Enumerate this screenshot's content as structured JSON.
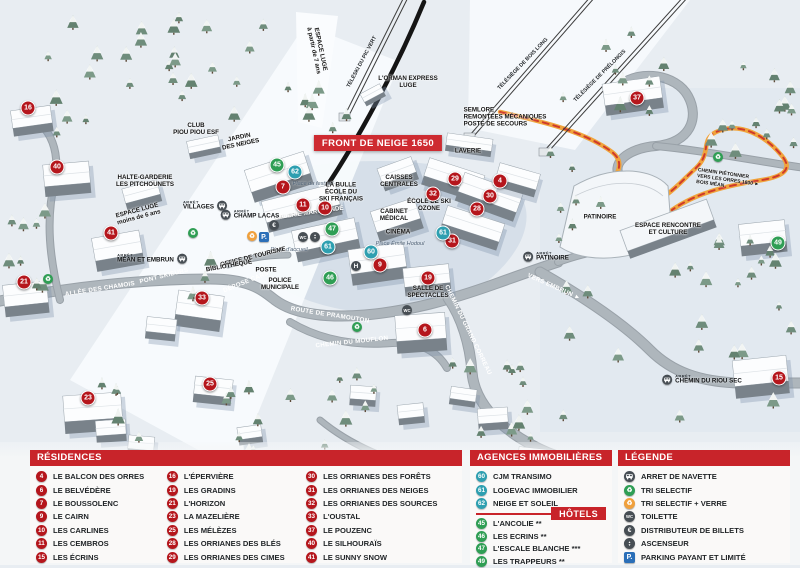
{
  "colors": {
    "residence": "#b5161c",
    "agency": "#2e9fb0",
    "hotel": "#2f9e54",
    "header_red": "#c8242a",
    "path_orange": "#f0a43c",
    "parking_blue": "#2b6fb8"
  },
  "map": {
    "banner": {
      "text": "FRONT DE NEIGE 1650",
      "bg": "#ce2b31"
    },
    "arret_prefix": "ARRÊT",
    "markers": [
      {
        "num": 16,
        "type": "residence",
        "x": 28,
        "y": 108
      },
      {
        "num": 40,
        "type": "residence",
        "x": 57,
        "y": 167
      },
      {
        "num": 41,
        "type": "residence",
        "x": 111,
        "y": 233
      },
      {
        "num": 21,
        "type": "residence",
        "x": 24,
        "y": 282
      },
      {
        "num": 33,
        "type": "residence",
        "x": 202,
        "y": 298
      },
      {
        "num": 23,
        "type": "residence",
        "x": 88,
        "y": 398
      },
      {
        "num": 25,
        "type": "residence",
        "x": 210,
        "y": 384
      },
      {
        "num": 7,
        "type": "residence",
        "x": 283,
        "y": 187
      },
      {
        "num": 11,
        "type": "residence",
        "x": 303,
        "y": 205
      },
      {
        "num": 10,
        "type": "residence",
        "x": 325,
        "y": 208
      },
      {
        "num": 9,
        "type": "residence",
        "x": 380,
        "y": 265
      },
      {
        "num": 19,
        "type": "residence",
        "x": 428,
        "y": 278
      },
      {
        "num": 6,
        "type": "residence",
        "x": 425,
        "y": 330
      },
      {
        "num": 29,
        "type": "residence",
        "x": 455,
        "y": 179
      },
      {
        "num": 4,
        "type": "residence",
        "x": 500,
        "y": 181
      },
      {
        "num": 32,
        "type": "residence",
        "x": 433,
        "y": 194
      },
      {
        "num": 30,
        "type": "residence",
        "x": 490,
        "y": 196
      },
      {
        "num": 28,
        "type": "residence",
        "x": 477,
        "y": 209
      },
      {
        "num": 31,
        "type": "residence",
        "x": 452,
        "y": 241
      },
      {
        "num": 37,
        "type": "residence",
        "x": 637,
        "y": 98
      },
      {
        "num": 15,
        "type": "residence",
        "x": 779,
        "y": 378
      },
      {
        "num": 62,
        "type": "agency",
        "x": 295,
        "y": 172
      },
      {
        "num": 61,
        "type": "agency",
        "x": 328,
        "y": 247
      },
      {
        "num": 61,
        "type": "agency",
        "x": 443,
        "y": 233
      },
      {
        "num": 60,
        "type": "agency",
        "x": 371,
        "y": 252
      },
      {
        "num": 45,
        "type": "hotel",
        "x": 277,
        "y": 165
      },
      {
        "num": 47,
        "type": "hotel",
        "x": 332,
        "y": 229
      },
      {
        "num": 46,
        "type": "hotel",
        "x": 330,
        "y": 278
      },
      {
        "num": 49,
        "type": "hotel",
        "x": 778,
        "y": 243
      }
    ],
    "poi_labels": [
      {
        "id": "club-piou-piou",
        "lines": [
          "CLUB",
          "PIOU PIOU ESF"
        ],
        "x": 196,
        "y": 129
      },
      {
        "id": "jardin-des-neiges",
        "lines": [
          "JARDIN",
          "DES NEIGES"
        ],
        "x": 240,
        "y": 141,
        "rot": -12
      },
      {
        "id": "halte-garderie",
        "lines": [
          "HALTE-GARDERIE",
          "LES PITCHOUNETS"
        ],
        "x": 145,
        "y": 181
      },
      {
        "id": "espace-luge-moins-6",
        "lines": [
          "ESPACE LUGE",
          "moins de 6 ans"
        ],
        "x": 138,
        "y": 214,
        "rot": -15
      },
      {
        "id": "espace-luge-7",
        "lines": [
          "ESPACE LUGE",
          "à partir de 7 ans"
        ],
        "x": 317,
        "y": 50,
        "rot": 78
      },
      {
        "id": "orman-express",
        "lines": [
          "L'ORMAN EXPRESS",
          "LUGE"
        ],
        "x": 408,
        "y": 82
      },
      {
        "id": "semlore",
        "lines": [
          "SEMLORE",
          "REMONTÉES MÉCANIQUES",
          "POSTE DE SECOURS"
        ],
        "x": 505,
        "y": 117,
        "cls": "left"
      },
      {
        "id": "laverie",
        "lines": [
          "LAVERIE"
        ],
        "x": 468,
        "y": 151
      },
      {
        "id": "caisses-centrales",
        "lines": [
          "CAISSES",
          "CENTRALES"
        ],
        "x": 399,
        "y": 181
      },
      {
        "id": "la-bulle-esf",
        "lines": [
          "LA BULLE",
          "ÉCOLE DU",
          "SKI FRANÇAIS"
        ],
        "x": 341,
        "y": 192
      },
      {
        "id": "ecole-ski-ozone",
        "lines": [
          "ÉCOLE DE SKI",
          "OZONE"
        ],
        "x": 429,
        "y": 205
      },
      {
        "id": "cabinet-medical",
        "lines": [
          "CABINET",
          "MÉDICAL"
        ],
        "x": 394,
        "y": 215
      },
      {
        "id": "cinema",
        "lines": [
          "CINÉMA"
        ],
        "x": 398,
        "y": 232
      },
      {
        "id": "galerie-marchande",
        "lines": [
          "GALERIE MARCHANDE"
        ],
        "x": 309,
        "y": 213,
        "cls": "white",
        "rot": -8
      },
      {
        "id": "office-de-tourisme",
        "lines": [
          "OFFICE DE TOURISME"
        ],
        "x": 253,
        "y": 257,
        "rot": -14
      },
      {
        "id": "bibliotheque",
        "lines": [
          "BIBLIOTHÈQUE"
        ],
        "x": 229,
        "y": 266,
        "rot": -10
      },
      {
        "id": "poste",
        "lines": [
          "POSTE"
        ],
        "x": 266,
        "y": 270
      },
      {
        "id": "police-municipale",
        "lines": [
          "POLICE",
          "MUNICIPALE"
        ],
        "x": 280,
        "y": 284
      },
      {
        "id": "salle-de-spectacles",
        "lines": [
          "SALLE DE",
          "SPECTACLES"
        ],
        "x": 428,
        "y": 292
      },
      {
        "id": "patinoire-batiment",
        "lines": [
          "PATINOIRE"
        ],
        "x": 600,
        "y": 217
      },
      {
        "id": "espace-rencontre",
        "lines": [
          "ESPACE RENCONTRE",
          "ET CULTURE"
        ],
        "x": 668,
        "y": 229
      },
      {
        "id": "chemin-pietonnier",
        "lines": [
          "CHEMIN PIÉTONNIER",
          "VERS LES ORRES 1800 ►",
          "BOIS MÉAN"
        ],
        "x": 728,
        "y": 181,
        "cls": "tiny left",
        "rot": 8
      }
    ],
    "place_labels": [
      {
        "text": "Place du festival",
        "x": 313,
        "y": 184
      },
      {
        "text": "Place d'accueil",
        "x": 289,
        "y": 250
      },
      {
        "text": "Place Émile Hodoul",
        "x": 400,
        "y": 244
      }
    ],
    "road_labels": [
      {
        "text": "ALLÉE DES CHAMOIS",
        "x": 100,
        "y": 289,
        "rot": -9
      },
      {
        "text": "PONT SKIEURS",
        "x": 164,
        "y": 276,
        "rot": -14
      },
      {
        "text": "DÉPOSE CARS",
        "x": 246,
        "y": 282,
        "rot": -22
      },
      {
        "text": "ROUTE DE PRAMOUTON",
        "x": 330,
        "y": 315,
        "rot": 9
      },
      {
        "text": "CHEMIN DU MOUFLON",
        "x": 352,
        "y": 342,
        "rot": -6
      },
      {
        "text": "CHEMIN DU GRAND CORREAU",
        "x": 468,
        "y": 330,
        "rot": 64
      },
      {
        "text": "VERS EMBRUN ►",
        "x": 554,
        "y": 287,
        "rot": 24
      }
    ],
    "lift_labels": [
      {
        "text": "TÉLÉSKI DU PIC VERT",
        "x": 362,
        "y": 62,
        "rot": -62
      },
      {
        "text": "TÉLÉSIÈGE DE BOIS LONG",
        "x": 523,
        "y": 64,
        "rot": -46
      },
      {
        "text": "TÉLÉSIÈGE DE PRÉLONGIS",
        "x": 600,
        "y": 76,
        "rot": -45
      }
    ],
    "bus_stops": [
      {
        "name": "VILLAGES",
        "x": 205,
        "y": 206,
        "icon_side": "right"
      },
      {
        "name": "MÉAN ET EMBRUN",
        "x": 152,
        "y": 259,
        "icon_side": "right"
      },
      {
        "name": "CHAMP LACAS",
        "x": 250,
        "y": 215,
        "icon_side": "left"
      },
      {
        "name": "PATINOIRE",
        "x": 546,
        "y": 257,
        "icon_side": "left"
      },
      {
        "name": "CHEMIN DU RIOU SEC",
        "x": 702,
        "y": 380,
        "icon_side": "left"
      }
    ],
    "facility_icons": [
      {
        "type": "recycle-green",
        "x": 48,
        "y": 279
      },
      {
        "type": "recycle-green",
        "x": 193,
        "y": 233
      },
      {
        "type": "recycle-green",
        "x": 357,
        "y": 327
      },
      {
        "type": "recycle-green",
        "x": 718,
        "y": 157
      },
      {
        "type": "recycle-orange",
        "x": 252,
        "y": 236
      },
      {
        "type": "parking",
        "x": 264,
        "y": 237
      },
      {
        "type": "euro",
        "x": 274,
        "y": 225
      },
      {
        "type": "wc",
        "x": 303,
        "y": 237
      },
      {
        "type": "elevator",
        "x": 315,
        "y": 237
      },
      {
        "type": "h",
        "x": 356,
        "y": 266
      },
      {
        "type": "wc",
        "x": 407,
        "y": 310
      }
    ]
  },
  "legend": {
    "residences": {
      "title": "RÉSIDENCES",
      "items": [
        {
          "num": 4,
          "label": "LE BALCON DES ORRES"
        },
        {
          "num": 6,
          "label": "LE BELVÉDÈRE"
        },
        {
          "num": 7,
          "label": "LE BOUSSOLENC"
        },
        {
          "num": 9,
          "label": "LE CAIRN"
        },
        {
          "num": 10,
          "label": "LES CARLINES"
        },
        {
          "num": 11,
          "label": "LES CEMBROS"
        },
        {
          "num": 15,
          "label": "LES ÉCRINS"
        },
        {
          "num": 16,
          "label": "L'ÉPERVIÈRE"
        },
        {
          "num": 19,
          "label": "LES GRADINS"
        },
        {
          "num": 21,
          "label": "L'HORIZON"
        },
        {
          "num": 23,
          "label": "LA MAZELIÈRE"
        },
        {
          "num": 25,
          "label": "LES MÉLÈZES"
        },
        {
          "num": 28,
          "label": "LES ORRIANES DES BLÉS"
        },
        {
          "num": 29,
          "label": "LES ORRIANES DES CIMES"
        },
        {
          "num": 30,
          "label": "LES ORRIANES DES FORÊTS"
        },
        {
          "num": 31,
          "label": "LES ORRIANES DES NEIGES"
        },
        {
          "num": 32,
          "label": "LES ORRIANES DES SOURCES"
        },
        {
          "num": 33,
          "label": "L'OUSTAL"
        },
        {
          "num": 37,
          "label": "LE POUZENC"
        },
        {
          "num": 40,
          "label": "LE SILHOURAÏS"
        },
        {
          "num": 41,
          "label": "LE SUNNY SNOW"
        }
      ]
    },
    "agencies": {
      "title": "AGENCES IMMOBILIÈRES",
      "items": [
        {
          "num": 60,
          "label": "CJM TRANSIMO"
        },
        {
          "num": 61,
          "label": "LOGEVAC IMMOBILIER"
        },
        {
          "num": 62,
          "label": "NEIGE ET SOLEIL"
        }
      ]
    },
    "hotels": {
      "title": "HÔTELS",
      "items": [
        {
          "num": 45,
          "label": "L'ANCOLIE **"
        },
        {
          "num": 46,
          "label": "LES ECRINS **"
        },
        {
          "num": 47,
          "label": "L'ESCALE BLANCHE ***"
        },
        {
          "num": 49,
          "label": "LES TRAPPEURS **"
        }
      ]
    },
    "legende": {
      "title": "LÉGENDE",
      "items": [
        {
          "icon": "bus",
          "label": "ARRET DE NAVETTE"
        },
        {
          "icon": "recycle-green",
          "label": "TRI SELECTIF"
        },
        {
          "icon": "recycle-orange",
          "label": "TRI SELECTIF + VERRE"
        },
        {
          "icon": "wc",
          "label": "TOILETTE"
        },
        {
          "icon": "euro",
          "label": "DISTRIBUTEUR DE BILLETS"
        },
        {
          "icon": "elevator",
          "label": "ASCENSEUR"
        },
        {
          "icon": "parking",
          "label": "PARKING PAYANT ET LIMITÉ"
        }
      ]
    }
  }
}
